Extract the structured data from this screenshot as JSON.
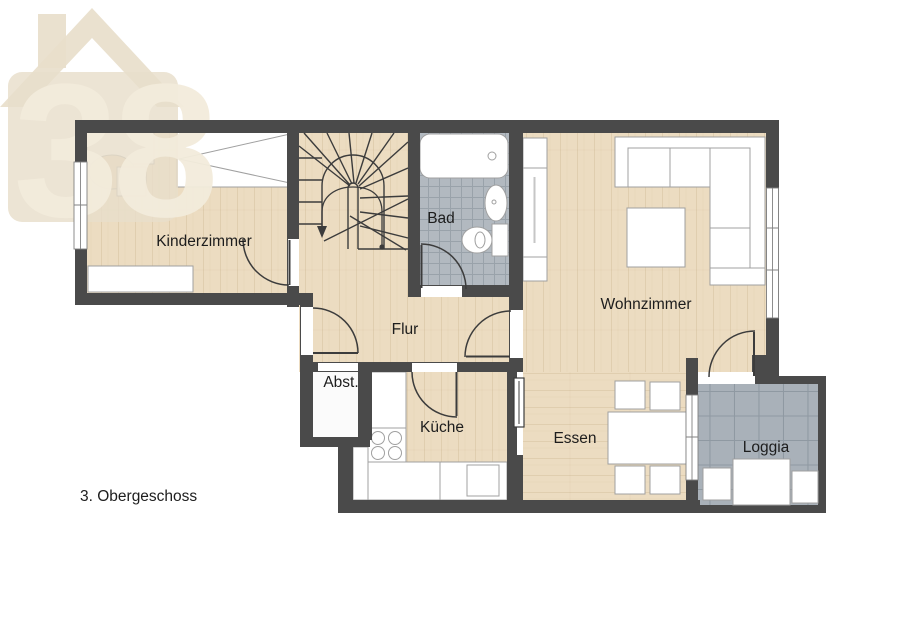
{
  "logo": {
    "house_number_text": "38"
  },
  "floor_plan": {
    "title": "3. Obergeschoss",
    "rooms": {
      "kinderzimmer": "Kinderzimmer",
      "bad": "Bad",
      "wohnzimmer": "Wohnzimmer",
      "flur": "Flur",
      "abstellraum": "Abst.",
      "kueche": "Küche",
      "essen": "Essen",
      "loggia": "Loggia"
    }
  },
  "colors": {
    "wall": "#4a4a4a",
    "wood": "#ecdcc1",
    "woodLine": "#c2a87f",
    "tileBad": "#b2b9c0",
    "tileBadLine": "#99a2aa",
    "tileLoggia": "#a9b1b9",
    "tileLoggiaLine": "#8f99a2",
    "furniture": "#ffffff",
    "furnitureStroke": "#a0a0a0",
    "line": "#3c3c3c",
    "text": "#1d1d1d",
    "logoBeige": "#e8decb",
    "logoCream": "#f3ecdc",
    "abstFloor": "#fbfbfb"
  }
}
